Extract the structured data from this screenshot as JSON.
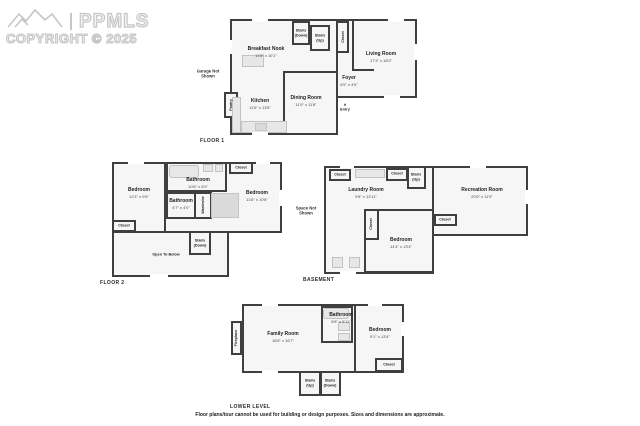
{
  "watermark": {
    "brand": "PPMLS",
    "copyright": "COPYRIGHT © 2025",
    "logo": "mountain-logo"
  },
  "disclaimer": "Floor plans/tour cannot be used for building or design purposes. Sizes and dimensions are approximate.",
  "colors": {
    "wall": "#3f3f3f",
    "room_fill": "#f6f6f6",
    "fixture": "#e7e7e7",
    "watermark": "#c6c6c6"
  },
  "f1": {
    "label": "FLOOR 1",
    "breakfast": {
      "n": "Breakfast Nook",
      "d": "11'8\" x 10'1\""
    },
    "living": {
      "n": "Living Room",
      "d": "17'3\" x 18'2\""
    },
    "kitchen": {
      "n": "Kitchen",
      "d": "11'6\" x 13'5\""
    },
    "dining": {
      "n": "Dining Room",
      "d": "11'9\" x 11'8\""
    },
    "foyer": {
      "n": "Foyer",
      "d": "6'5\" x 4'6\""
    },
    "stairs_down": "Stairs (Down)",
    "stairs_up": "Stairs (Up)",
    "closet": "Closet",
    "pantry": "Pantry",
    "garage": "Garage Not Shown",
    "entry": "Entry",
    "entry_arrow": "▲"
  },
  "f2": {
    "label": "FLOOR 2",
    "bedroom_left": {
      "n": "Bedroom",
      "d": "12'4\" x 9'8\""
    },
    "bathroom_top": {
      "n": "Bathroom",
      "d": "10'6\" x 5'0\""
    },
    "bathroom_small": {
      "n": "Bathroom",
      "d": "4'7\" x 4'0\""
    },
    "bedroom_right": {
      "n": "Bedroom",
      "d": "11'8\" x 10'8\""
    },
    "wardrobe": "Wardrobe",
    "closet_tr": "Closet",
    "closet_bl": "Closet",
    "stairs_down": "Stairs (Down)",
    "open_below": "Open To Below"
  },
  "bsmt": {
    "label": "BASEMENT",
    "laundry": {
      "n": "Laundry Room",
      "d": "9'8\" x 13'11\""
    },
    "recreation": {
      "n": "Recreation Room",
      "d": "20'6\" x 11'9\""
    },
    "bedroom": {
      "n": "Bedroom",
      "d": "14'4\" x 13'4\""
    },
    "closet_tl": "Closet",
    "closet_tc": "Closet",
    "closet_mid": "Closet",
    "closet_side": "Closet",
    "stairs_up": "Stairs (Up)",
    "space": "Space Not Shown"
  },
  "ll": {
    "label": "LOWER LEVEL",
    "family": {
      "n": "Family Room",
      "d": "18'6\" x 16'7\""
    },
    "bathroom": {
      "n": "Bathroom",
      "d": "8'8\" x 5'11\""
    },
    "bedroom": {
      "n": "Bedroom",
      "d": "9'1\" x 13'4\""
    },
    "closet": "Closet",
    "fireplace": "Fireplace",
    "stairs_up": "Stairs (Up)",
    "stairs_down": "Stairs (Down)"
  }
}
